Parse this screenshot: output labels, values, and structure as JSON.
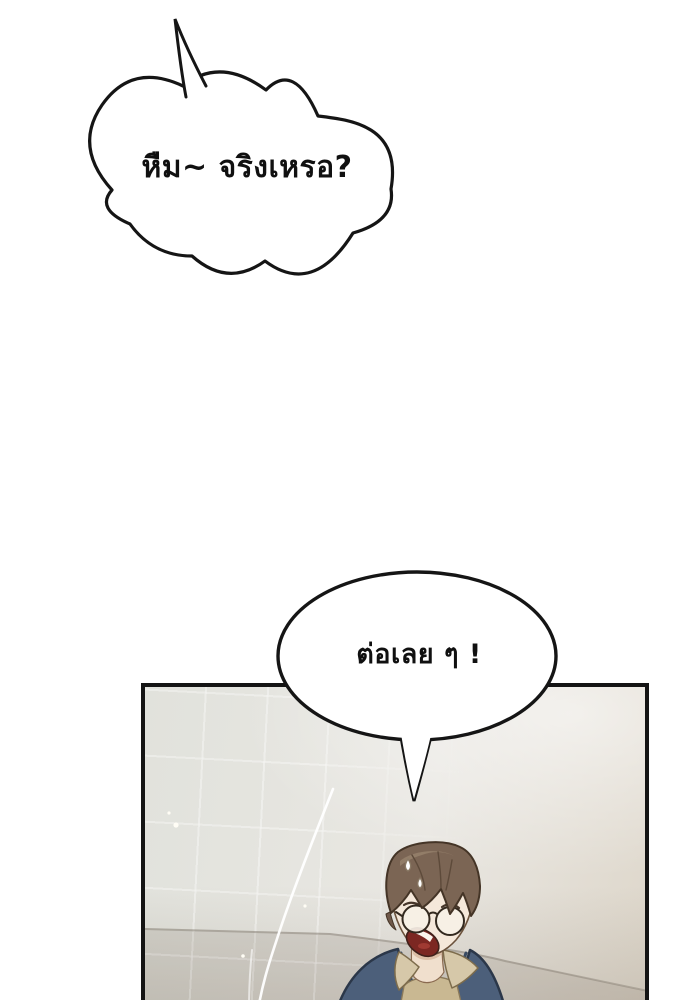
{
  "page": {
    "background_color": "#ffffff",
    "width": 700,
    "height": 1000
  },
  "bubbles": [
    {
      "shape": "cloud",
      "text": "หืม~ จริงเหรอ?",
      "tail_direction": "up-left-spike",
      "fill": "#ffffff",
      "outline": "#151515"
    },
    {
      "shape": "oval",
      "text": "ต่อเลย ๆ !",
      "tail_direction": "down",
      "fill": "#ffffff",
      "outline": "#151515"
    }
  ],
  "panel": {
    "border_color": "#141414",
    "wall_color": "#e6e4de",
    "wall_warm_color": "#ded7cb",
    "counter_edge_color": "#9a9080",
    "setting": "tiled bathroom wall"
  },
  "character": {
    "hair_color": "#7b6554",
    "hair_highlight_color": "#95806a",
    "skin_color": "#f5e8da",
    "sweater_color": "#4c5f7a",
    "shirt_collar_color": "#d6c8a9",
    "shirt_inner_color": "#c9b892",
    "mouth_color": "#7c2722",
    "glasses_lens_color": "#f6f0e6",
    "expression": "shocked open mouth",
    "accessories": "round glasses, sweat drops"
  },
  "effects": {
    "light_streak_color": "#ffffff",
    "sparkle_color": "#fffdf5"
  }
}
